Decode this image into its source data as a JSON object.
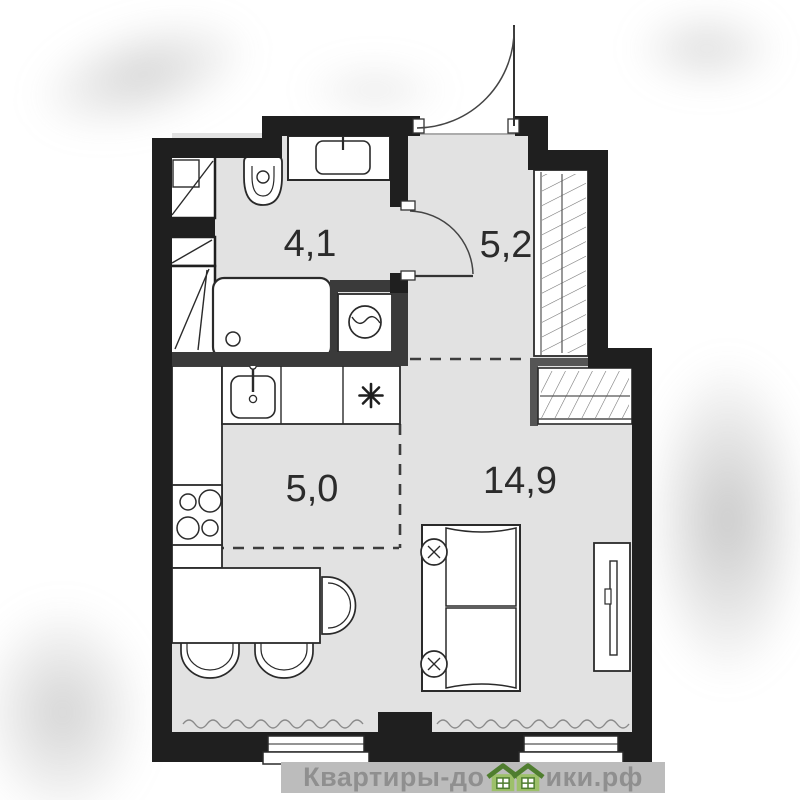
{
  "floorplan": {
    "type": "studio-apartment-floor-plan",
    "rooms": [
      {
        "name": "bathroom",
        "area_label": "4,1"
      },
      {
        "name": "hallway",
        "area_label": "5,2"
      },
      {
        "name": "kitchen",
        "area_label": "5,0"
      },
      {
        "name": "living-room",
        "area_label": "14,9"
      }
    ],
    "stove_mark": "✳",
    "fixtures": [
      "toilet",
      "vanity-sink",
      "bathtub",
      "washing-machine",
      "vent-shaft",
      "entrance-door",
      "interior-door",
      "wardrobe-tall",
      "wardrobe-niche",
      "kitchen-sink",
      "counter",
      "stove-burners",
      "dining-table",
      "chair",
      "sofa",
      "tv-stand",
      "window",
      "radiator-squiggle"
    ],
    "colors": {
      "wall": "#1f1f1f",
      "interior_wall": "#3a3a3a",
      "floor": "#e2e2e2",
      "furniture_fill": "#ffffff",
      "furniture_outline": "#2a2a2a",
      "dashed_line": "#3d3d3d",
      "hatch": "#6f6f6f",
      "label_text": "#2b2b2b"
    }
  },
  "watermark": {
    "brand": "Квартиры-домики.рф",
    "prefix": "Квартиры-до",
    "suffix": "ики.рф",
    "text_color": "#8f8f8f",
    "band_color": "#bcbcbc",
    "house_body_color": "#9dc06a",
    "house_roof_color": "#4f7d2f"
  }
}
